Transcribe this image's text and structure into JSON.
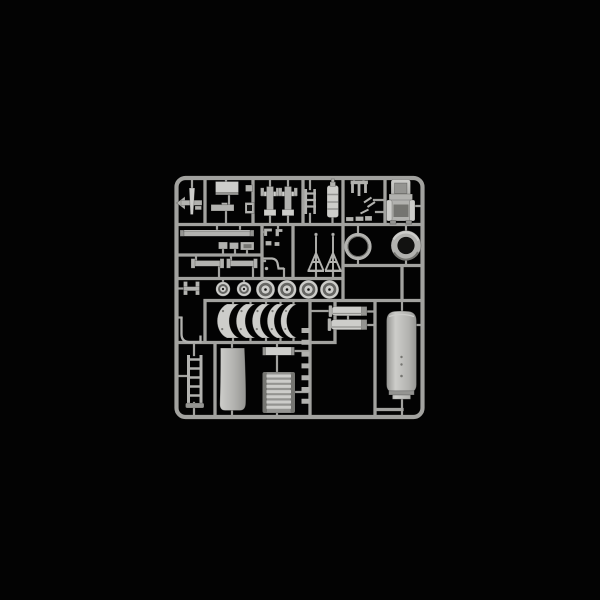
{
  "image": {
    "type": "product-photo",
    "subject": "injection-moulded plastic model kit sprue (parts tree)",
    "alt": "Light grey plastic model kit sprue on a black background, holding road wheels, curved fenders, a large fuel tank, mufflers, a seat, rings, ladders and many small detail parts",
    "background_description": "solid black studio background"
  },
  "colors": {
    "background": "#030303",
    "runner": "#a2a29f",
    "runner_shadow": "#6b6b68",
    "plastic_bright": "#cdcdca",
    "plastic_mid": "#b2b2af",
    "plastic_dim": "#949491",
    "plastic_shadow": "#757571",
    "tire_dark": "#676764",
    "hole_dark": "#121211"
  },
  "parts_visible": [
    {
      "name": "sprue-frame",
      "description": "rounded rectangular outer runner frame"
    },
    {
      "name": "part-arrow",
      "description": "small dart / arrow shaped bracket, top left"
    },
    {
      "name": "part-rect-panel-small",
      "description": "bright rectangular hatch panel"
    },
    {
      "name": "part-tray",
      "description": "flat tray lid below the hatch panel"
    },
    {
      "name": "part-trunnion-mounts",
      "description": "two T-shaped mount parts"
    },
    {
      "name": "part-ladder-small",
      "description": "small ladder frame"
    },
    {
      "name": "part-bottle",
      "description": "ribbed cylindrical bottle (fire extinguisher)"
    },
    {
      "name": "part-fork-rake",
      "description": "small forked rake part and tiny clips"
    },
    {
      "name": "part-seat",
      "description": "padded seat with backrest, top right"
    },
    {
      "name": "part-ring-thin",
      "description": "thin open ring"
    },
    {
      "name": "part-ring-thick",
      "description": "thick ring with dark hub hole"
    },
    {
      "name": "part-tripods",
      "description": "two folded tripod legs"
    },
    {
      "name": "part-long-bar",
      "description": "long flat bar"
    },
    {
      "name": "part-thin-bars",
      "description": "two thin bars with end tabs"
    },
    {
      "name": "part-wheels",
      "description": "six road wheels in a row"
    },
    {
      "name": "part-fenders",
      "description": "five curved crescent fender sections"
    },
    {
      "name": "part-panel",
      "description": "large bright tapered panel"
    },
    {
      "name": "part-grille-comb",
      "description": "slotted grille bar"
    },
    {
      "name": "part-louvre-cylinder",
      "description": "ribbed louvre / rolled tarp cylinder"
    },
    {
      "name": "part-clip-tabs",
      "description": "column of seven small clips"
    },
    {
      "name": "part-mufflers",
      "description": "two exhaust mufflers"
    },
    {
      "name": "part-fuel-tank",
      "description": "large cylindrical fuel tank with notched foot"
    },
    {
      "name": "part-ladder",
      "description": "vertical ladder with foot plate"
    },
    {
      "name": "part-wire-hook",
      "description": "bent wire hook"
    },
    {
      "name": "part-h-bracket",
      "description": "small H-shaped bracket"
    }
  ]
}
